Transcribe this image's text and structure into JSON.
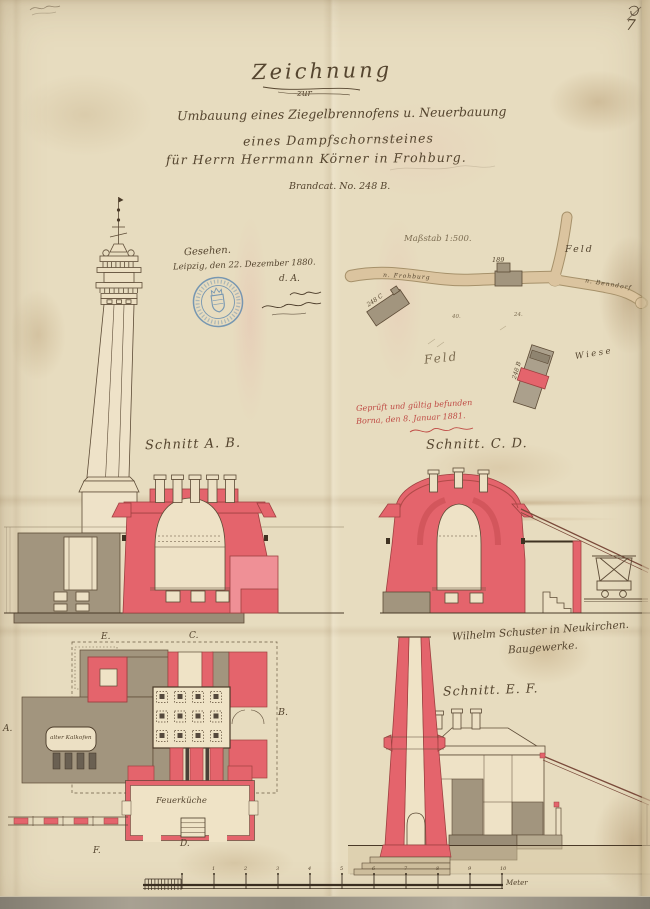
{
  "page": {
    "number": "7"
  },
  "title_block": {
    "heading": "Zeichnung",
    "connector": "zur",
    "line1": "Umbauung eines Ziegelbrennofens u. Neuerbauung",
    "line2": "eines Dampfschornsteines",
    "line3": "für Herrn Herrmann Körner in Frohburg.",
    "file_ref": "Brandcat. No. 248 B."
  },
  "approval_note": {
    "seen": "Gesehen.",
    "place_date": "Leipzig, den 22. Dezember 1880.",
    "initials": "d. A."
  },
  "inspection_note": {
    "line1": "Geprüft und gültig befunden",
    "line2": "Borna, den 8. Januar 1881."
  },
  "builder_note": {
    "line1": "Wilhelm Schuster in Neukirchen.",
    "line2": "Baugewerke."
  },
  "site_map": {
    "scale_label": "Maßstab 1:500.",
    "field_label_top": "Feld",
    "field_label_center": "Feld",
    "meadow_label": "Wiese",
    "road_west": "n. Frohburg",
    "road_east": "n. Benndorf",
    "parcel_building_1": "189",
    "parcel_building_2": "248 C",
    "parcel_building_3": "248 B",
    "parcel_no_1": "40.",
    "parcel_no_2": "24."
  },
  "section_labels": {
    "ab": "Schnitt A. B.",
    "cd": "Schnitt. C. D.",
    "ef": "Schnitt. E. F."
  },
  "plan_labels": {
    "old_kiln": "alter Kalkofen",
    "fire_kitchen": "Feuerküche",
    "marker_a": "A.",
    "marker_b": "B.",
    "marker_c": "C.",
    "marker_d": "D.",
    "marker_e": "E.",
    "marker_f": "F."
  },
  "scale_bar": {
    "unit_label": "Meter",
    "tick_numbers": [
      "1",
      "2",
      "3",
      "4",
      "5",
      "6",
      "7",
      "8",
      "9",
      "10"
    ]
  },
  "colors": {
    "paper": "#e7dcbf",
    "ink": "#55452f",
    "new_construction_red": "#e4646c",
    "existing_gray": "#a2957e",
    "road_tan": "#dbc49f",
    "red_ink": "#bf4a44",
    "stamp_blue": "#4d7dad"
  }
}
